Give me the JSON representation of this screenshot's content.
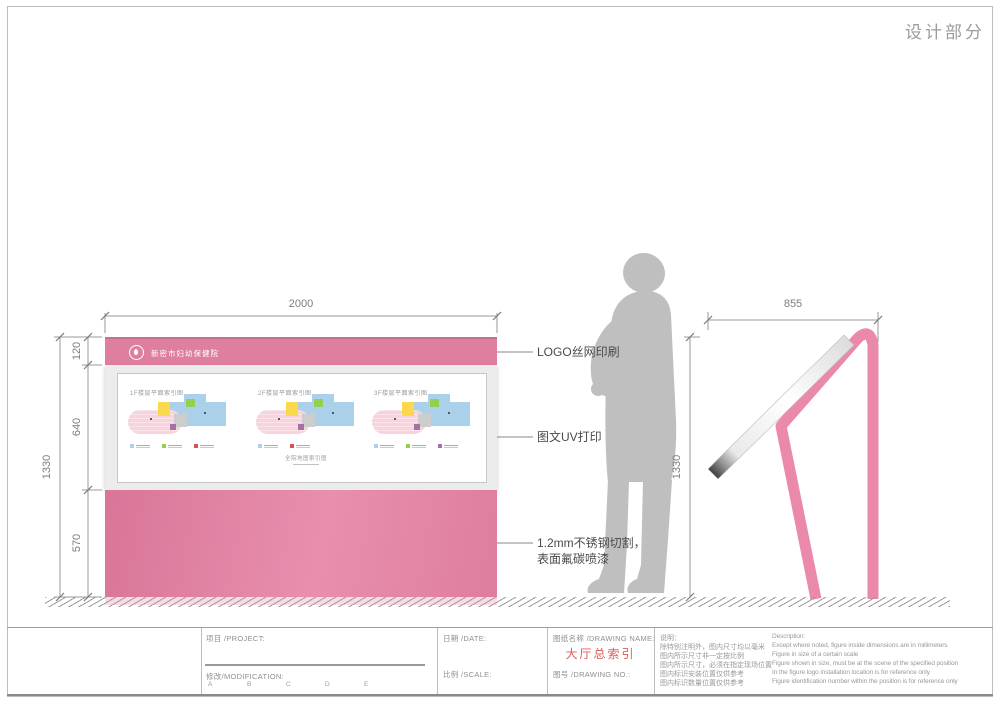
{
  "page": {
    "title": "设计部分"
  },
  "front_view": {
    "logo_text": "新密市妇幼保健院",
    "panel_caption": "全院地图索引图",
    "maps": [
      {
        "title": "1F楼层平面索引图"
      },
      {
        "title": "2F楼层平面索引图"
      },
      {
        "title": "3F楼层平面索引图"
      }
    ],
    "dimensions": {
      "width": "2000",
      "header": "120",
      "panel": "640",
      "base": "570",
      "total": "1330"
    }
  },
  "side_view": {
    "dimensions": {
      "depth": "855",
      "height": "1330"
    }
  },
  "annotations": {
    "logo": "LOGO丝网印刷",
    "print": "图文UV打印",
    "material_line1": "1.2mm不锈钢切割，",
    "material_line2": "表面氟碳喷漆"
  },
  "title_block": {
    "project_label": "项目 /PROJECT:",
    "modification_label": "修改/MODIFICATION:",
    "revision_marks": [
      "A",
      "B",
      "C",
      "D",
      "E"
    ],
    "date_label": "日期 /DATE:",
    "scale_label": "比例 /SCALE:",
    "drawing_name_label": "图纸名称 /DRAWING NAME:",
    "drawing_name_value": "大厅总索引",
    "drawing_no_label": "图号 /DRAWING NO.:",
    "notes_cn": {
      "title": "说明：",
      "lines": [
        "除特别注明外，图内尺寸均以毫米",
        "图内所示尺寸非一定按比例",
        "图内所示尺寸，必须在指定现场位置",
        "图内标识安装位置仅供参考",
        "图内标识数量位置仅供参考"
      ]
    },
    "notes_en": {
      "title": "Description:",
      "lines": [
        "Except where noted, figure inside dimensions are in millimeters",
        "Figure in size of a certain scale",
        "Figure shown in size, must be at the scene of the specified position",
        "In the figure logo installation location is for reference only",
        "Figure identification number within the position is for reference only"
      ]
    }
  },
  "colors": {
    "pink_primary": "#df7fa0",
    "pink_side_frame": "#ea89ab",
    "drawing_name_red": "#e05c5c",
    "silhouette_gray": "#bfbfbf"
  }
}
